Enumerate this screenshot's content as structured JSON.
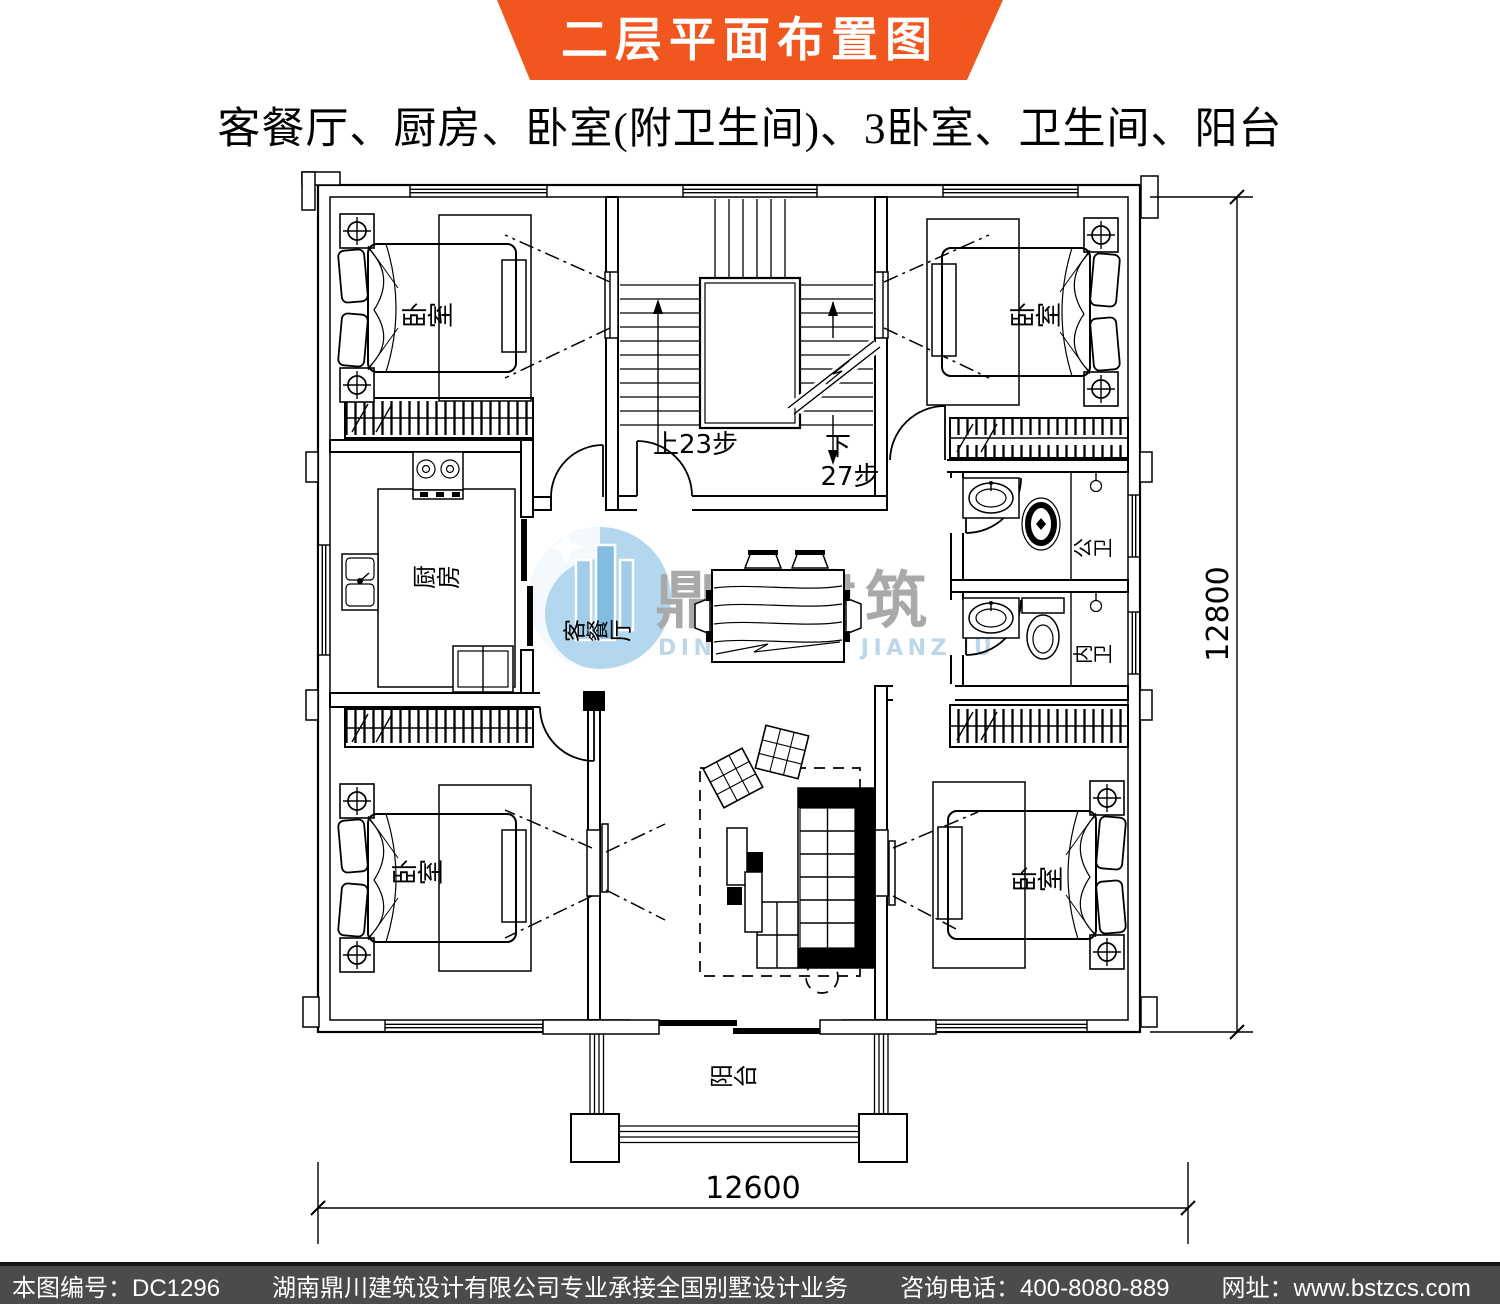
{
  "banner": {
    "title": "二层平面布置图"
  },
  "subtitle": "客餐厅、厨房、卧室(附卫生间)、3卧室、卫生间、阳台",
  "watermark": {
    "brand": "鼎川建筑",
    "brand_romanized": "DINGCHUAN JIANZHU"
  },
  "plan": {
    "rooms": {
      "bedroom_top_left": "卧室",
      "bedroom_top_right": "卧室",
      "bedroom_bottom_left": "卧室",
      "bedroom_bottom_right": "卧室",
      "kitchen": "厨房",
      "living_dining": "客餐厅",
      "bathroom_public": "公卫",
      "bathroom_ensuite": "内卫",
      "balcony": "阳台"
    },
    "stairs": {
      "up": "上23步",
      "down": "下",
      "down_steps": "27步"
    },
    "dimensions": {
      "side": "12800",
      "bottom": "12600"
    }
  },
  "footer": {
    "drawing_no": "本图编号：DC1296",
    "company_line": "湖南鼎川建筑设计有限公司专业承接全国别墅设计业务",
    "phone": "咨询电话：400-8080-889",
    "website": "网址：www.bstzcs.com"
  },
  "colors": {
    "banner_orange": "#f1561f",
    "footer_gray": "#4b4b4b",
    "watermark_blue": "#a9d2ec",
    "watermark_text_gray": "#a5a5a5"
  }
}
